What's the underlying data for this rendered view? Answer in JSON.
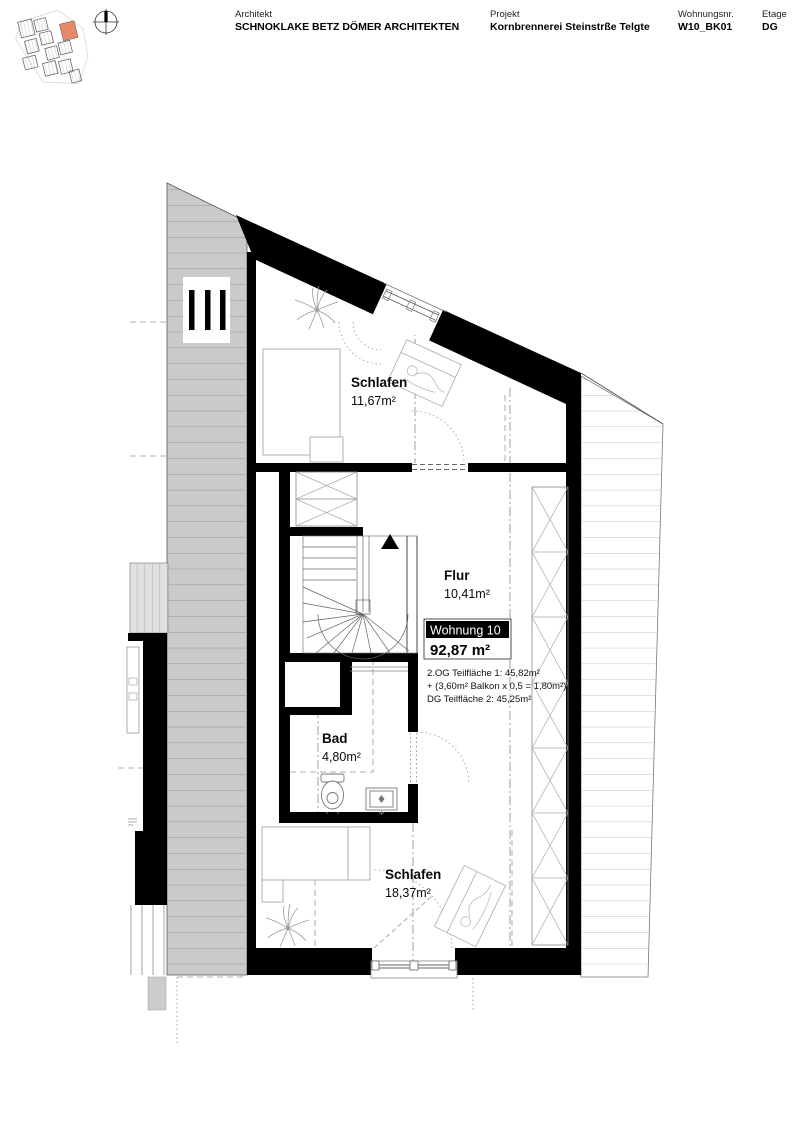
{
  "header": {
    "architect": {
      "label": "Architekt",
      "value": "SCHNOKLAKE BETZ DÖMER ARCHITEKTEN"
    },
    "project": {
      "label": "Projekt",
      "value": "Kornbrennerei Steinstrße Telgte"
    },
    "unit": {
      "label": "Wohnungsnr.",
      "value": "W10_BK01"
    },
    "floor": {
      "label": "Etage",
      "value": "DG"
    }
  },
  "site_plan": {
    "highlight_color": "#E8896C"
  },
  "plan": {
    "rooms": [
      {
        "name": "Schlafen",
        "area": "11,67m²"
      },
      {
        "name": "Flur",
        "area": "10,41m²"
      },
      {
        "name": "Bad",
        "area": "4,80m²"
      },
      {
        "name": "Schlafen",
        "area": "18,37m²"
      }
    ],
    "unit_badge": {
      "title": "Wohnung 10",
      "total_area": "92,87 m²"
    },
    "area_breakdown": [
      "2.OG Teilfläche 1: 45,82m²",
      "+ (3,60m² Balkon x 0,5 = 1,80m²)",
      "DG Teilfläche 2: 45,25m²"
    ]
  }
}
